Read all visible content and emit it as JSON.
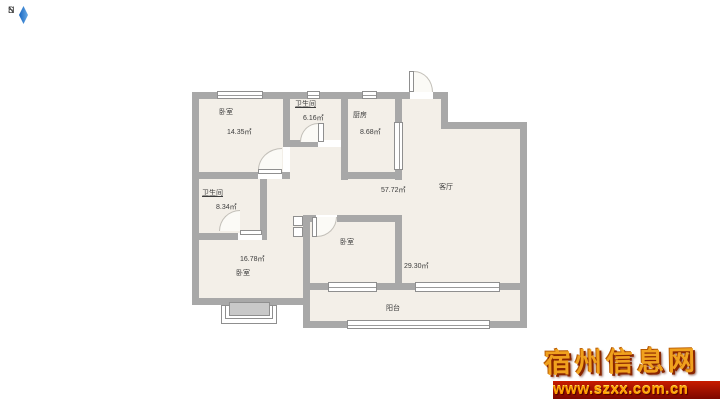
{
  "plan": {
    "colors": {
      "wall": "#a8a8a8",
      "floor": "#f3efe8",
      "background": "#ffffff"
    },
    "compass": {
      "north": "N",
      "south": "S",
      "needle_color": "#2e7cd0"
    },
    "rooms": [
      {
        "id": "bedroom-top-left",
        "name": "卧室",
        "area": "14.35㎡"
      },
      {
        "id": "bathroom-top",
        "name": "卫生间",
        "area": "6.16㎡"
      },
      {
        "id": "kitchen",
        "name": "厨房",
        "area": "8.68㎡"
      },
      {
        "id": "living-room",
        "name": "客厅",
        "area": "57.72㎡"
      },
      {
        "id": "bathroom-left",
        "name": "卫生间",
        "area": "8.34㎡"
      },
      {
        "id": "bedroom-bottom-left",
        "name": "卧室",
        "area": "16.78㎡"
      },
      {
        "id": "bedroom-middle",
        "name": "卧室",
        "area": "29.30㎡"
      },
      {
        "id": "balcony",
        "name": "阳台"
      }
    ]
  },
  "watermark": {
    "site_name": "宿州信息网",
    "url": "www.szxx.com.cn",
    "title_color": "#f0a11e",
    "bar_color": "#8a0b00",
    "url_color": "#ff9d00"
  }
}
